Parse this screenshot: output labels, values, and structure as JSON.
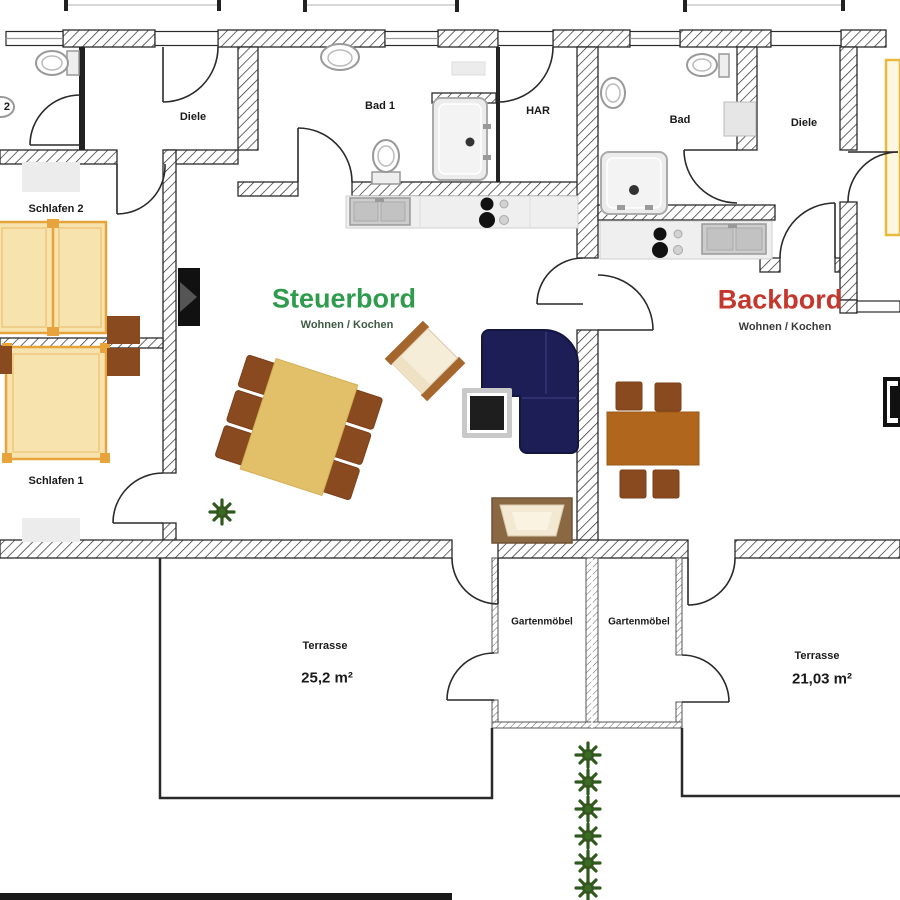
{
  "apartments": {
    "steuerbord": {
      "title": "Steuerbord",
      "subtitle": "Wohnen / Kochen",
      "title_color": "#2e9b4d"
    },
    "backbord": {
      "title": "Backbord",
      "subtitle": "Wohnen / Kochen",
      "title_color": "#c5372c"
    }
  },
  "rooms": {
    "bad2": "Bad 2",
    "diele_left": "Diele",
    "bad1": "Bad 1",
    "har": "HAR",
    "schlafen2": "Schlafen 2",
    "schlafen1": "Schlafen 1",
    "bad_right": "Bad",
    "diele_right": "Diele",
    "gartenmoebel_left": "Gartenmöbel",
    "gartenmoebel_right": "Gartenmöbel"
  },
  "terraces": {
    "left": {
      "label": "Terrasse",
      "area": "25,2 m²"
    },
    "right": {
      "label": "Terrasse",
      "area": "21,03 m²"
    }
  },
  "palette": {
    "wall_line": "#2a2a2a",
    "bed_fill": "#f7e3ae",
    "bed_frame": "#e8a43c",
    "table_light": "#e2c06a",
    "table_dark": "#b0661c",
    "chair_brown": "#8a4a20",
    "sofa_navy": "#1c1e55",
    "plant_green": "#2f5a1d"
  }
}
